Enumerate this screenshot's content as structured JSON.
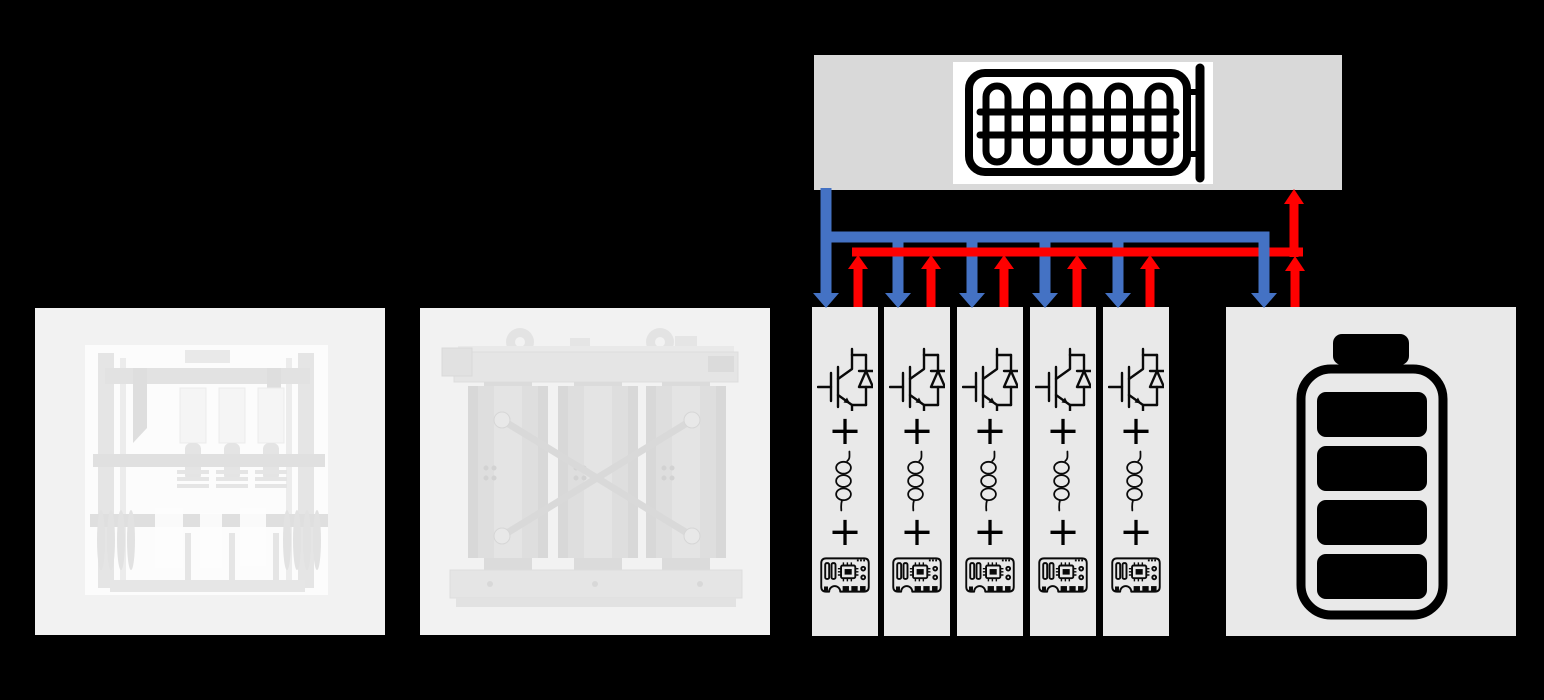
{
  "canvas": {
    "width": 1544,
    "height": 700,
    "background": "#000000"
  },
  "colors": {
    "flow_down_blue": "#4472C4",
    "flow_up_red": "#FF0000",
    "heater_panel_bg": "#D9D9D9",
    "module_bg": "#E9E9E9",
    "battery_bg": "#E9E9E9",
    "photo_bg": "#F2F2F2",
    "icon_black": "#000000"
  },
  "photos": [
    {
      "icon": "switchgear-photo"
    },
    {
      "icon": "transformer-photo"
    }
  ],
  "heater_panel": {
    "icon": "heating-element-icon",
    "coil_loops": 5
  },
  "converter_modules": {
    "count": 5,
    "plus_symbol": "+",
    "component_icons": [
      "igbt-with-diode-icon",
      "inductor-icon",
      "control-board-icon"
    ]
  },
  "battery_panel": {
    "icon": "battery-icon",
    "cells": 4
  },
  "flow_arrows": {
    "blue_down_arrow_count": 6,
    "red_up_arrow_count": 7
  }
}
